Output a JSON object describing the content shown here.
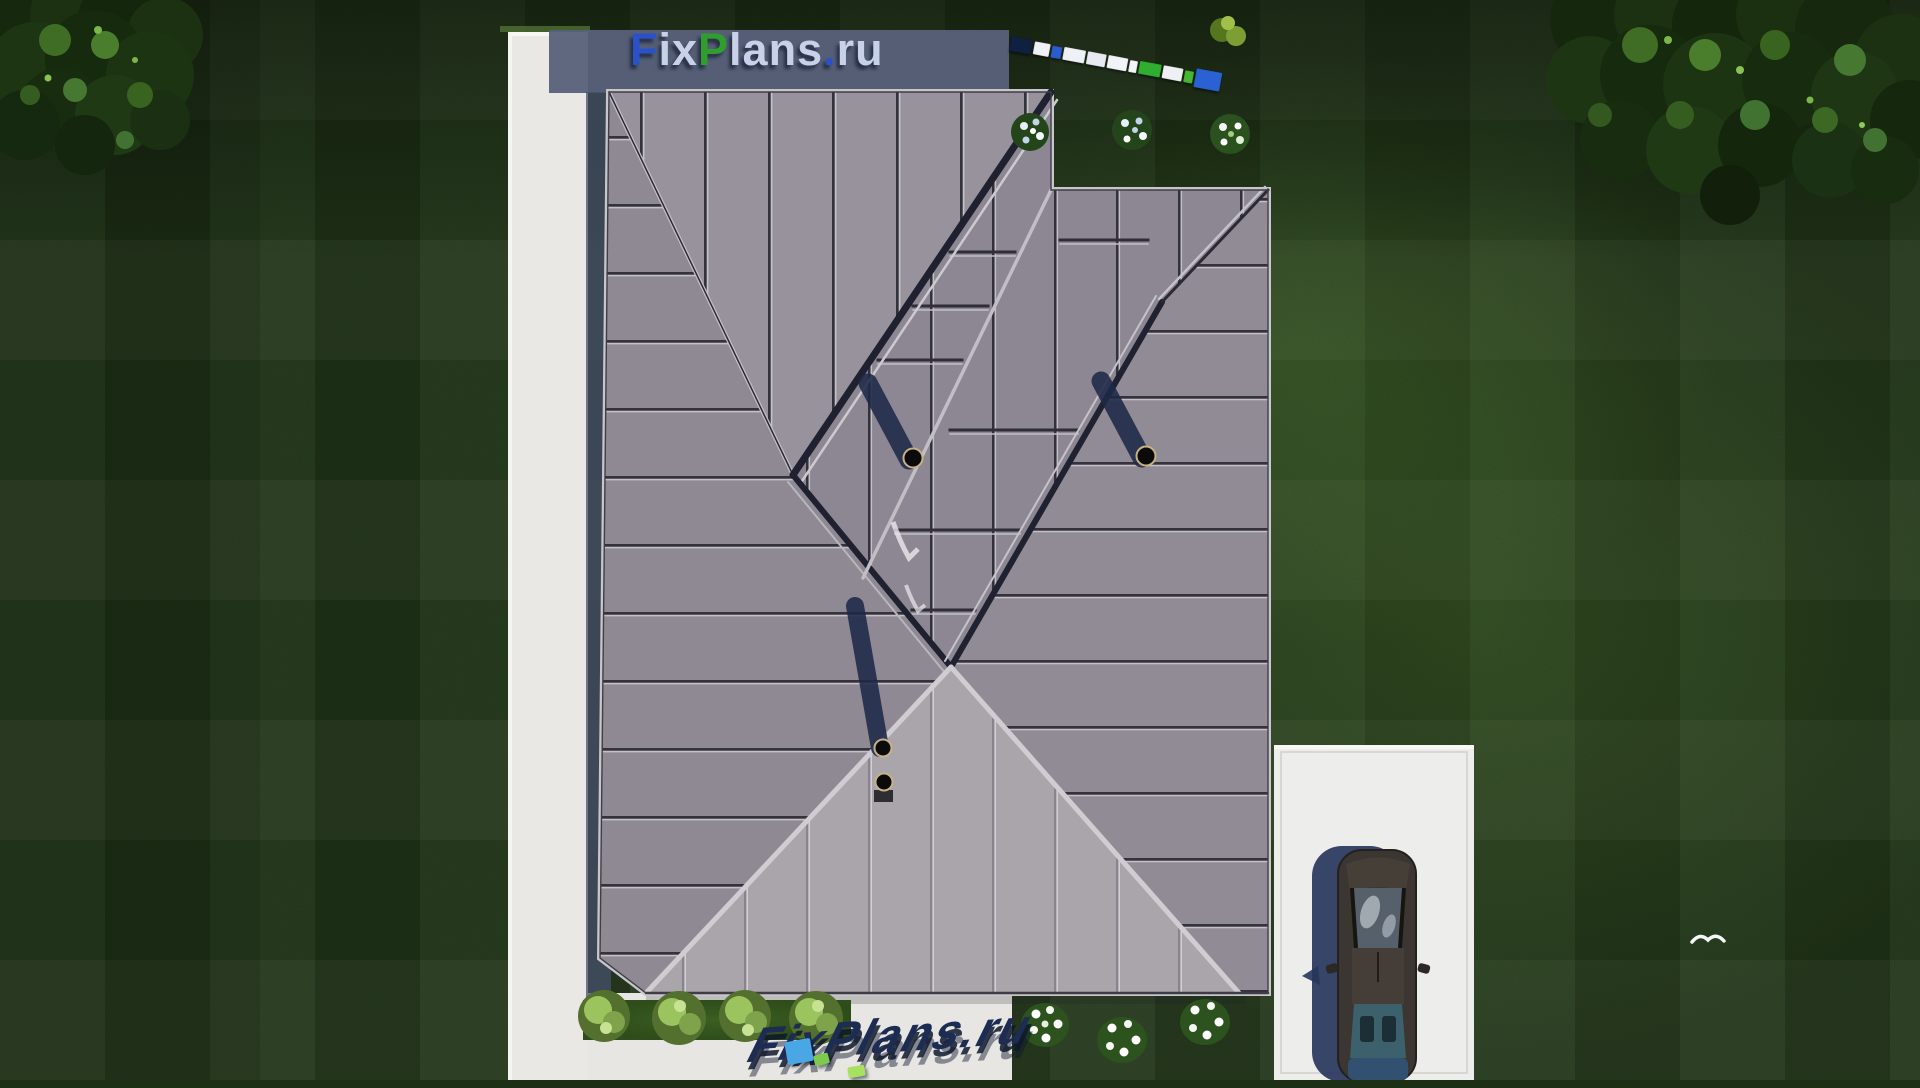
{
  "branding": {
    "site_watermark": {
      "text": "FixPlans.ru",
      "parts": [
        {
          "t": "F",
          "c": "#2a52c8"
        },
        {
          "t": "ix",
          "c": "#c7d1e8"
        },
        {
          "t": "P",
          "c": "#2f9e2e"
        },
        {
          "t": "lans",
          "c": "#c7d1e8"
        },
        {
          "t": ".",
          "c": "#2a52c8"
        },
        {
          "t": "ru",
          "c": "#c7d1e8"
        }
      ]
    },
    "ground_watermark": {
      "text": "FixPlans.ru",
      "color": "#1d2c52",
      "accent_blue": "#49a7e6",
      "accent_green_1": "#7ec94f",
      "accent_green_2": "#a8e060"
    }
  },
  "scale_bar": {
    "angle_deg": 10.5,
    "segments": [
      {
        "c": "#10203f",
        "w": 22,
        "h": 15
      },
      {
        "c": "#eef1f5",
        "w": 16,
        "h": 13
      },
      {
        "c": "#2a5bd0",
        "w": 10,
        "h": 12
      },
      {
        "c": "#eef1f5",
        "w": 22,
        "h": 13
      },
      {
        "c": "#e7ebf1",
        "w": 19,
        "h": 13
      },
      {
        "c": "#f1f3f6",
        "w": 20,
        "h": 13
      },
      {
        "c": "#f4f5f7",
        "w": 8,
        "h": 12
      },
      {
        "c": "#2fae2f",
        "w": 22,
        "h": 13
      },
      {
        "c": "#eef0f3",
        "w": 20,
        "h": 13
      },
      {
        "c": "#45b832",
        "w": 9,
        "h": 12
      },
      {
        "c": "#2a62d6",
        "w": 26,
        "h": 19
      }
    ]
  },
  "scene": {
    "palette": {
      "lawn": "#22361a",
      "roof_dark_slope": "#8e8992",
      "roof_light_slope": "#a9a5ab",
      "pavement": "#e9e8e5",
      "building_shadow": "#59617a",
      "car_shadow": "#26365c",
      "foliage": "#1b3111",
      "flower_white": "#f4f6f2"
    },
    "objects": [
      "lawn",
      "hip-roof",
      "roof-vent-pipes",
      "walkway",
      "terrace",
      "driveway",
      "sedan-car",
      "flower-bushes",
      "hedge-bushes",
      "trees",
      "bird"
    ]
  }
}
